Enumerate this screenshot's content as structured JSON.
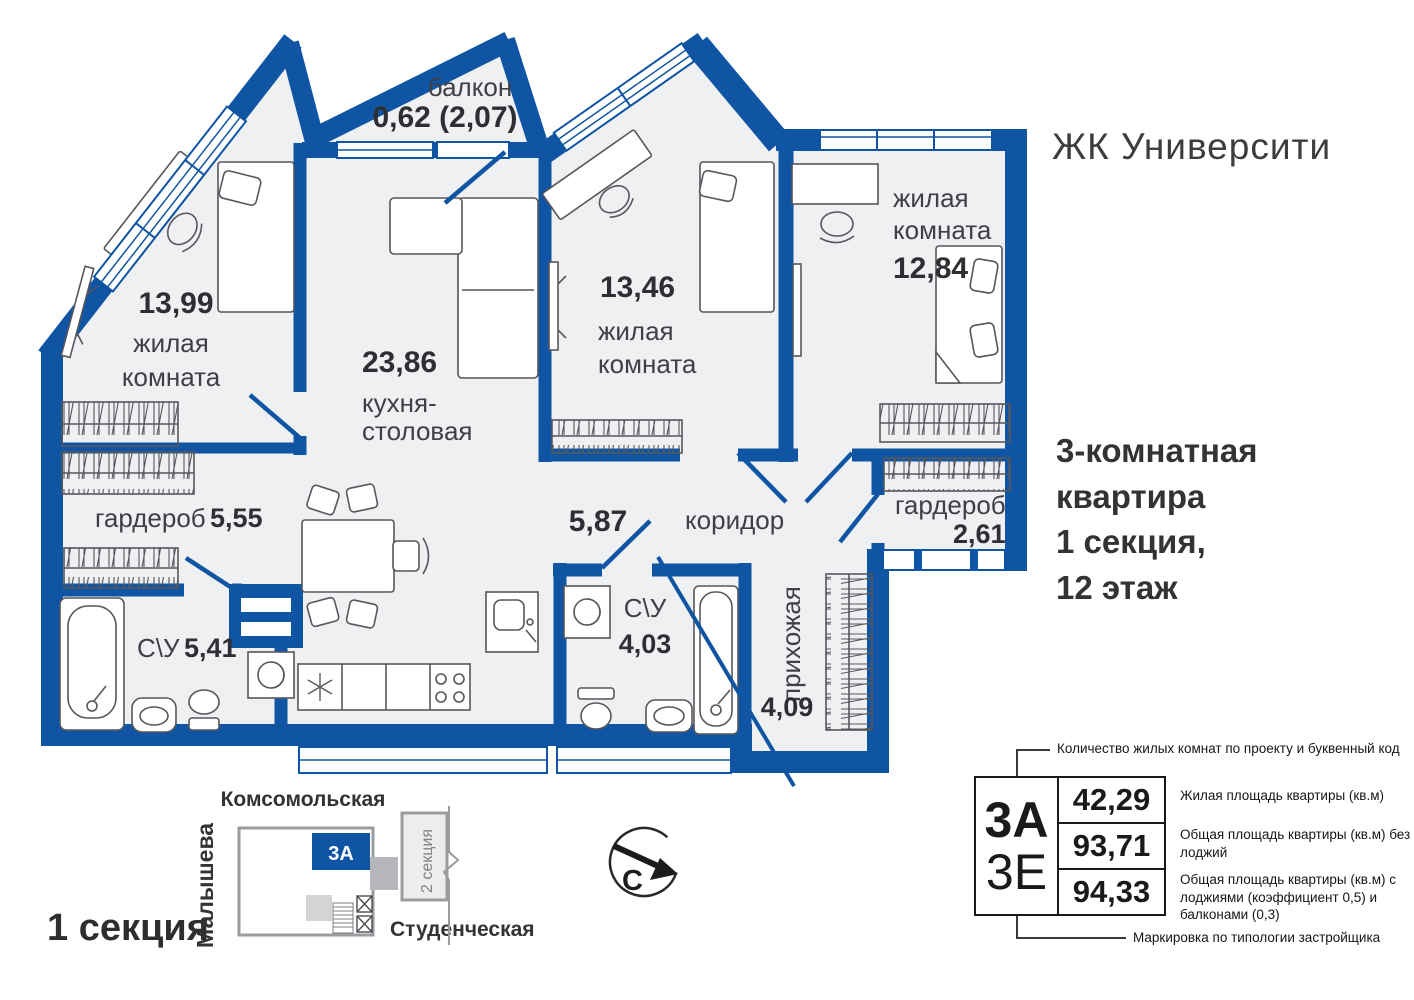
{
  "header": {
    "title": "ЖК Университи"
  },
  "apartment": {
    "lines": [
      "3-комнатная",
      "квартира",
      "1 секция,",
      "12 этаж"
    ]
  },
  "plan": {
    "balcony": {
      "name": "балкон",
      "area": "0,62 (2,07)"
    },
    "living1": {
      "area": "13,99",
      "name_line1": "жилая",
      "name_line2": "комната"
    },
    "kitchen": {
      "area": "23,86",
      "name_line1": "кухня-",
      "name_line2": "столовая"
    },
    "living2": {
      "area": "13,46",
      "name_line1": "жилая",
      "name_line2": "комната"
    },
    "living3": {
      "area": "12,84",
      "name_line1": "жилая",
      "name_line2": "комната"
    },
    "wardrobe1": {
      "name": "гардероб",
      "area": "5,55"
    },
    "bathroom1": {
      "name": "С\\У",
      "area": "5,41"
    },
    "corridor": {
      "name": "коридор",
      "area": "5,87"
    },
    "bathroom2": {
      "name": "С\\У",
      "area": "4,03"
    },
    "hallway": {
      "name": "прихожая",
      "area": "4,09"
    },
    "wardrobe2": {
      "name": "гардероб",
      "area": "2,61"
    }
  },
  "site": {
    "section_label": "1 секция",
    "street_top": "Комсомольская",
    "street_left": "Малышева",
    "street_bottom": "Студенческая",
    "neighbor_section": "2 секция",
    "unit_code": "3А",
    "compass_north": "С"
  },
  "legend": {
    "top_note": "Количество жилых комнат по проекту и буквенный код",
    "code_top": "3А",
    "code_bottom": "3Е",
    "rows": [
      {
        "value": "42,29",
        "label": "Жилая площадь квартиры (кв.м)"
      },
      {
        "value": "93,71",
        "label": "Общая площадь квартиры (кв.м) без лоджий"
      },
      {
        "value": "94,33",
        "label": "Общая площадь квартиры (кв.м) с лоджиями (коэффициент 0,5) и балконами (0,3)"
      }
    ],
    "bottom_note": "Маркировка по типологии застройщика"
  },
  "colors": {
    "wall_blue": "#0F55A3",
    "room_fill": "#EEF0F2",
    "text_dark": "#333333"
  }
}
